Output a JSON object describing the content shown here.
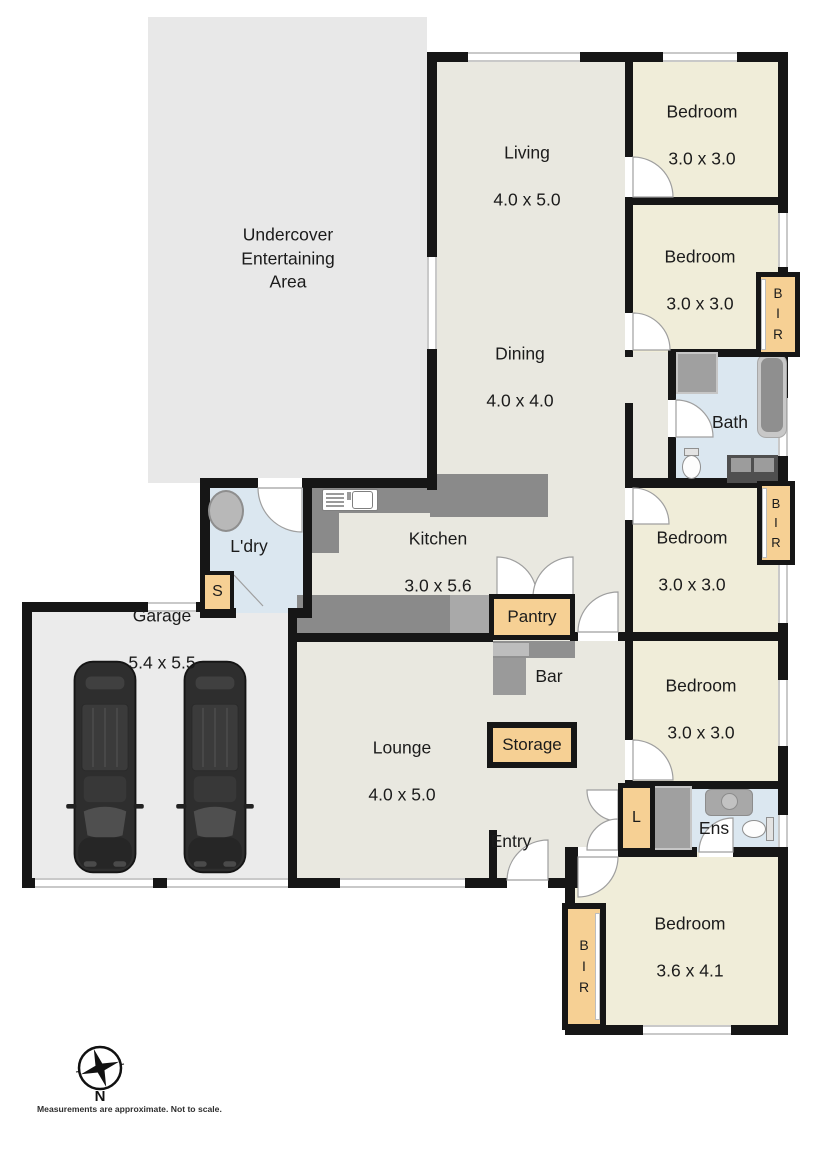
{
  "rooms": {
    "undercover": {
      "name": "Undercover\nEntertaining\nArea"
    },
    "living": {
      "name": "Living",
      "dims": "4.0 x 5.0"
    },
    "dining": {
      "name": "Dining",
      "dims": "4.0 x 4.0"
    },
    "kitchen": {
      "name": "Kitchen",
      "dims": "3.0 x 5.6"
    },
    "laundry": {
      "name": "L'dry"
    },
    "garage": {
      "name": "Garage",
      "dims": "5.4 x 5.5"
    },
    "lounge": {
      "name": "Lounge",
      "dims": "4.0 x 5.0"
    },
    "bar": {
      "name": "Bar"
    },
    "entry": {
      "name": "Entry"
    },
    "bath": {
      "name": "Bath"
    },
    "ensuite": {
      "name": "Ens"
    },
    "bedroom1": {
      "name": "Bedroom",
      "dims": "3.0 x 3.0"
    },
    "bedroom2": {
      "name": "Bedroom",
      "dims": "3.0 x 3.0"
    },
    "bedroom3": {
      "name": "Bedroom",
      "dims": "3.0 x 3.0"
    },
    "bedroom4": {
      "name": "Bedroom",
      "dims": "3.0 x 3.0"
    },
    "bedroom5": {
      "name": "Bedroom",
      "dims": "3.6 x 4.1"
    }
  },
  "closets": {
    "pantry": "Pantry",
    "storage": "Storage",
    "linen": "L",
    "store": "S",
    "bir": "B\nI\nR"
  },
  "compass": {
    "north": "N"
  },
  "disclaimer": "Measurements are approximate. Not to scale.",
  "colors": {
    "wall": "#161616",
    "floor": "#e9e8e0",
    "bedroom": "#f0edd9",
    "wet": "#dbe7f0",
    "closet": "#f6d094",
    "outdoor": "#e8e8e8",
    "garage": "#ebebeb",
    "counter": "#8a8a8a",
    "car": "#2e2e2e"
  }
}
